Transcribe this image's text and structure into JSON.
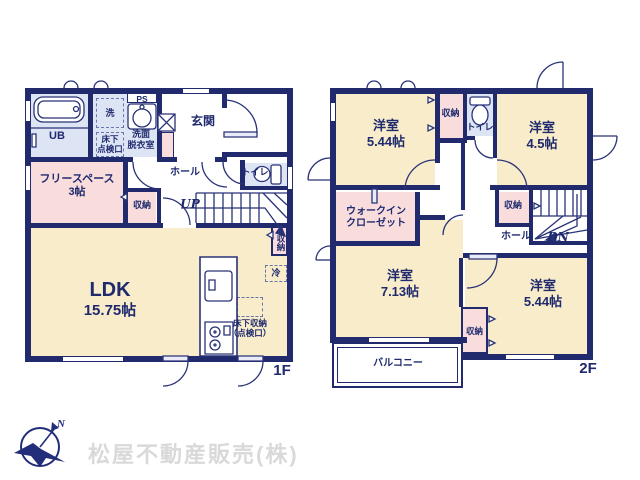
{
  "colors": {
    "wall": "#202a6d",
    "cream": "#f8ecca",
    "pink": "#f9dddd",
    "blue": "#dde5f5",
    "text": "#1f2a6e"
  },
  "floor1": {
    "floor_label": "1F",
    "bath": "UB",
    "washer": "洗",
    "ps": "PS",
    "hatch_l1": "床下",
    "hatch_l2": "点検口",
    "washroom_l1": "洗面",
    "washroom_l2": "脱衣室",
    "entrance": "玄関",
    "free_l1": "フリースペース",
    "free_l2": "3帖",
    "closet_hall": "収納",
    "hall": "ホール",
    "toilet": "トイレ",
    "up": "UP",
    "closet_stairs": "収納",
    "fridge": "冷",
    "ldk_l1": "LDK",
    "ldk_l2": "15.75帖",
    "underfloor_l1": "床下収納",
    "underfloor_l2": "（点検口）"
  },
  "floor2": {
    "floor_label": "2F",
    "room_nw_l1": "洋室",
    "room_nw_l2": "5.44帖",
    "closet_top": "収納",
    "toilet": "トイレ",
    "room_ne_l1": "洋室",
    "room_ne_l2": "4.5帖",
    "wic_l1": "ウォークイン",
    "wic_l2": "クローゼット",
    "closet_stairs": "収納",
    "hall": "ホール",
    "dn": "DN",
    "room_sw_l1": "洋室",
    "room_sw_l2": "7.13帖",
    "closet_mid": "収納",
    "room_se_l1": "洋室",
    "room_se_l2": "5.44帖",
    "balcony": "バルコニー"
  },
  "footer": {
    "company": "松屋不動産販売(株)",
    "north": "N"
  }
}
